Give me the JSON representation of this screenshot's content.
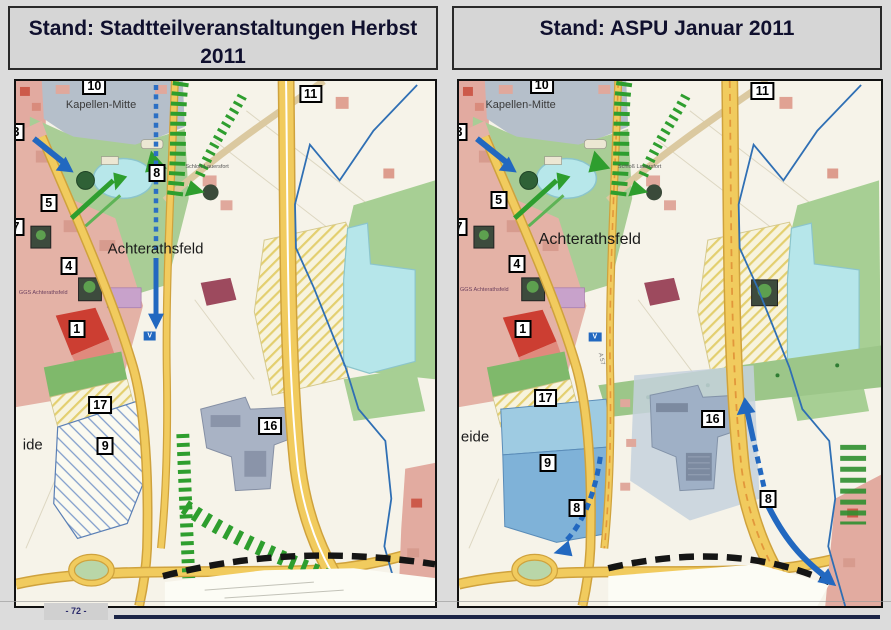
{
  "slide": {
    "background": "#dcdcdc",
    "page_number": "- 72 -",
    "footer_rule_color": "#1b2547",
    "title_text_color": "#10102e"
  },
  "panels": [
    {
      "title": "Stand: Stadtteilveranstaltungen Herbst 2011"
    },
    {
      "title": "Stand: ASPU Januar 2011"
    }
  ],
  "palette": {
    "map_background": "#f6f3e9",
    "park_green": "#a9cd96",
    "field_green": "#a7cf94",
    "urban_pink": "#e4b2a6",
    "highlight_red": "#cc3e32",
    "water_cyan": "#b6e6ea",
    "building_gray_blue": "#a9b3c5",
    "planned_area_blue": "#7fb2d8",
    "road_yellow": "#f1cb5e",
    "route_blue": "#2268c0",
    "corridor_green": "#2e9e2e",
    "boundary_blue": "#2f6fb4",
    "marker_background": "#ffffff"
  },
  "maps": [
    {
      "side": "left",
      "markers": [
        {
          "label": "10",
          "x": 18.7,
          "y": 1.0,
          "partial": true
        },
        {
          "label": "11",
          "x": 70.3,
          "y": 2.4
        },
        {
          "label": "3",
          "x": 0,
          "y": 9.8,
          "partial": true
        },
        {
          "label": "8",
          "x": 33.6,
          "y": 17.6
        },
        {
          "label": "5",
          "x": 7.8,
          "y": 23.3
        },
        {
          "label": "7",
          "x": 0,
          "y": 27.8,
          "partial": true
        },
        {
          "label": "4",
          "x": 12.6,
          "y": 35.2
        },
        {
          "label": "1",
          "x": 14.5,
          "y": 47.3
        },
        {
          "label": "17",
          "x": 20.1,
          "y": 61.7
        },
        {
          "label": "9",
          "x": 21.3,
          "y": 69.5
        },
        {
          "label": "16",
          "x": 60.7,
          "y": 65.7
        }
      ],
      "labels": [
        {
          "text": "Kapellen-Mitte",
          "x": 20.3,
          "y": 4.5,
          "size": 11,
          "color": "#3a3a3a"
        },
        {
          "text": "Achterathsfeld",
          "x": 33.3,
          "y": 32.0,
          "size": 15,
          "color": "#1a1a1a"
        },
        {
          "text": "ide",
          "x": 4.0,
          "y": 69.3,
          "size": 15,
          "color": "#1a1a1a"
        },
        {
          "text": "Schloß Lauersfort",
          "x": 45.6,
          "y": 16.3,
          "size": 5.5,
          "color": "#555555"
        },
        {
          "text": "GGS Achterathsfeld",
          "x": 6.5,
          "y": 40.3,
          "size": 5.5,
          "color": "#6b3f5e"
        },
        {
          "text": "V",
          "x": 31.9,
          "y": 48.6,
          "size": 7,
          "kind": "sign"
        }
      ]
    },
    {
      "side": "right",
      "markers": [
        {
          "label": "10",
          "x": 19.6,
          "y": 0.8,
          "partial": true
        },
        {
          "label": "11",
          "x": 71.9,
          "y": 1.9
        },
        {
          "label": "3",
          "x": 0,
          "y": 9.8,
          "partial": true
        },
        {
          "label": "5",
          "x": 9.4,
          "y": 22.7
        },
        {
          "label": "7",
          "x": 0,
          "y": 27.8,
          "partial": true
        },
        {
          "label": "4",
          "x": 13.7,
          "y": 34.8
        },
        {
          "label": "1",
          "x": 15.1,
          "y": 47.3
        },
        {
          "label": "17",
          "x": 20.5,
          "y": 60.4
        },
        {
          "label": "9",
          "x": 21.0,
          "y": 72.7
        },
        {
          "label": "8",
          "x": 27.9,
          "y": 81.3
        },
        {
          "label": "16",
          "x": 60.1,
          "y": 64.4
        },
        {
          "label": "8",
          "x": 73.3,
          "y": 79.7
        }
      ],
      "labels": [
        {
          "text": "Kapellen-Mitte",
          "x": 14.6,
          "y": 4.5,
          "size": 11,
          "color": "#3a3a3a"
        },
        {
          "text": "Achterathsfeld",
          "x": 31.0,
          "y": 30.2,
          "size": 16,
          "color": "#1a1a1a"
        },
        {
          "text": "eide",
          "x": 3.8,
          "y": 67.9,
          "size": 15,
          "color": "#1a1a1a"
        },
        {
          "text": "Schloß Lauersfort",
          "x": 42.8,
          "y": 16.4,
          "size": 5.5,
          "color": "#555555"
        },
        {
          "text": "GGS Achterathsfeld",
          "x": 6.0,
          "y": 39.8,
          "size": 5.5,
          "color": "#6b3f5e"
        },
        {
          "text": "A 57",
          "x": 33.7,
          "y": 53.0,
          "size": 6,
          "rot": 78,
          "color": "#777777"
        },
        {
          "text": "V",
          "x": 32.2,
          "y": 48.8,
          "size": 7,
          "kind": "sign"
        }
      ]
    }
  ]
}
